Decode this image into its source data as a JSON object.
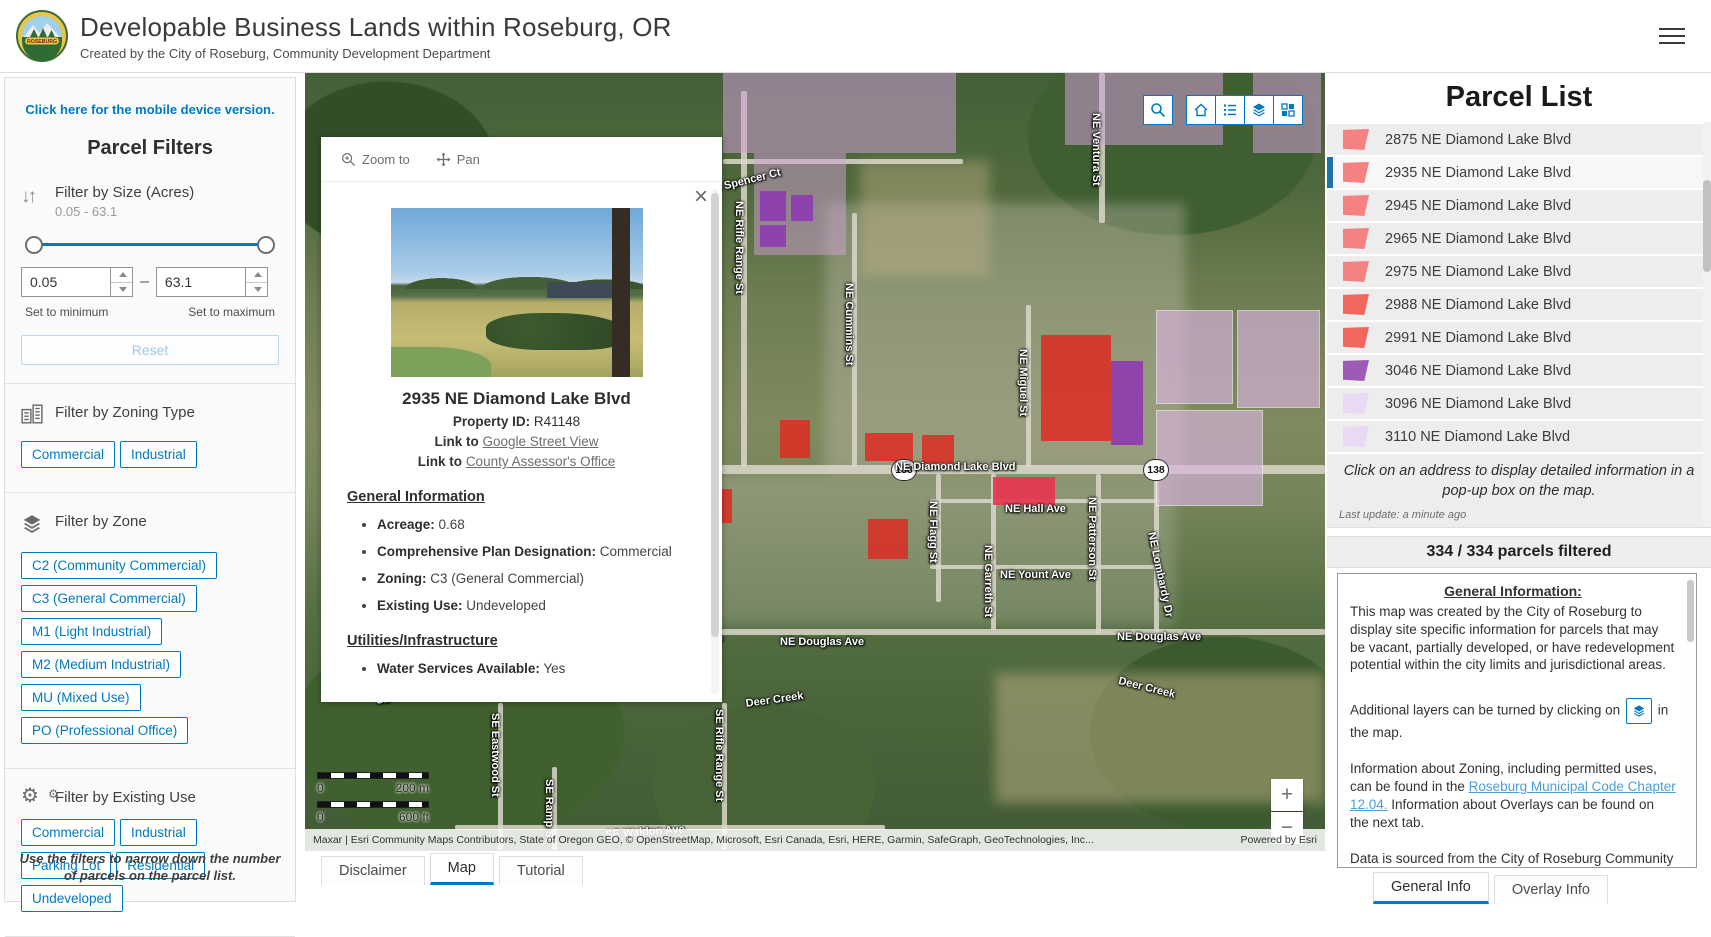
{
  "header": {
    "title": "Developable Business Lands within Roseburg, OR",
    "subtitle": "Created by the City of Roseburg, Community Development Department",
    "logo_text": "ROSEBURG"
  },
  "filters": {
    "mobile_link": "Click here for the mobile device version.",
    "title": "Parcel Filters",
    "size": {
      "label": "Filter by Size (Acres)",
      "range_text": "0.05 - 63.1",
      "min_value": "0.05",
      "max_value": "63.1",
      "separator": "–",
      "min_caption": "Set to minimum",
      "max_caption": "Set to maximum",
      "reset_label": "Reset"
    },
    "zoning_type": {
      "label": "Filter by Zoning Type",
      "buttons": [
        "Commercial",
        "Industrial"
      ]
    },
    "zone": {
      "label": "Filter by Zone",
      "buttons": [
        "C2 (Community Commercial)",
        "C3 (General Commercial)",
        "M1 (Light Industrial)",
        "M2 (Medium Industrial)",
        "MU (Mixed Use)",
        "PO (Professional Office)"
      ]
    },
    "existing_use": {
      "label": "Filter by Existing Use",
      "buttons": [
        "Commercial",
        "Industrial",
        "Parking Lot",
        "Residential",
        "Undeveloped"
      ]
    },
    "footer_note": "Use the filters to narrow down the number of parcels on the parcel list."
  },
  "popup": {
    "zoom_to": "Zoom to",
    "pan": "Pan",
    "title": "2935 NE Diamond Lake Blvd",
    "property_id_label": "Property ID:",
    "property_id": "R41148",
    "link_label": "Link to",
    "link1": "Google Street View",
    "link2": "County Assessor's Office",
    "section_general": "General Information",
    "general_bullets": [
      {
        "label": "Acreage:",
        "value": "0.68"
      },
      {
        "label": "Comprehensive Plan Designation:",
        "value": "Commercial"
      },
      {
        "label": "Zoning:",
        "value": "C3 (General Commercial)"
      },
      {
        "label": "Existing Use:",
        "value": "Undeveloped"
      }
    ],
    "section_utilities": "Utilities/Infrastructure",
    "utilities_bullets": [
      {
        "label": "Water Services Available:",
        "value": "Yes"
      }
    ]
  },
  "map": {
    "toolbar_icons": [
      "search",
      "home",
      "legend",
      "layers",
      "basemap"
    ],
    "zoom_in": "+",
    "zoom_out": "−",
    "scale_m_start": "0",
    "scale_m_end": "200 m",
    "scale_ft_start": "0",
    "scale_ft_end": "600 ft",
    "attribution": "Maxar | Esri Community Maps Contributors, State of Oregon GEO, © OpenStreetMap, Microsoft, Esri Canada, Esri, HERE, Garmin, SafeGraph, GeoTechnologies, Inc...",
    "powered_by": "Powered by Esri",
    "highway_shields": [
      {
        "text": "138",
        "x": 586,
        "y": 386
      },
      {
        "text": "138",
        "x": 838,
        "y": 386
      }
    ],
    "street_labels": [
      {
        "text": "NE Spencer Ct",
        "x": 400,
        "y": 112,
        "r": -14
      },
      {
        "text": "NE Rifle Range St",
        "x": 440,
        "y": 128,
        "r": 90
      },
      {
        "text": "NE Cummins St",
        "x": 550,
        "y": 210,
        "r": 90
      },
      {
        "text": "NE Ventura St",
        "x": 797,
        "y": 40,
        "r": 90
      },
      {
        "text": "NE Miguel St",
        "x": 724,
        "y": 276,
        "r": 90
      },
      {
        "text": "NE Diamond Lake Blvd",
        "x": 590,
        "y": 388,
        "r": 0
      },
      {
        "text": "NE Hall Ave",
        "x": 700,
        "y": 430,
        "r": 0
      },
      {
        "text": "NE Flagg St",
        "x": 634,
        "y": 428,
        "r": 90
      },
      {
        "text": "NE Garreth St",
        "x": 689,
        "y": 472,
        "r": 90
      },
      {
        "text": "NE Yount Ave",
        "x": 695,
        "y": 496,
        "r": 0
      },
      {
        "text": "NE Patterson St",
        "x": 793,
        "y": 424,
        "r": 90
      },
      {
        "text": "NE Lombardy Dr",
        "x": 852,
        "y": 458,
        "r": 78
      },
      {
        "text": "Ave",
        "x": 398,
        "y": 560,
        "r": 0
      },
      {
        "text": "NE Douglas Ave",
        "x": 475,
        "y": 563,
        "r": 0
      },
      {
        "text": "NE Douglas Ave",
        "x": 812,
        "y": 558,
        "r": 0
      },
      {
        "text": "Deer Creek",
        "x": 440,
        "y": 625,
        "r": -8
      },
      {
        "text": "Deer Creek",
        "x": 815,
        "y": 602,
        "r": 14
      },
      {
        "text": "SE Hillside Dr",
        "x": 70,
        "y": 622,
        "r": -10
      },
      {
        "text": "SE Eastwood St",
        "x": 196,
        "y": 640,
        "r": 90
      },
      {
        "text": "SE Ramp St",
        "x": 250,
        "y": 706,
        "r": 90
      },
      {
        "text": "SE Rifle Range St",
        "x": 420,
        "y": 636,
        "r": 90
      },
      {
        "text": "SE Waldon Ave",
        "x": 300,
        "y": 756,
        "r": -4
      }
    ],
    "roads": [
      {
        "x": 18,
        "y": 392,
        "w": 1002,
        "h": 9
      },
      {
        "x": 395,
        "y": 556,
        "w": 625,
        "h": 6
      },
      {
        "x": 150,
        "y": 752,
        "w": 430,
        "h": 5
      },
      {
        "x": 418,
        "y": 86,
        "w": 240,
        "h": 5
      },
      {
        "x": 436,
        "y": 18,
        "w": 6,
        "h": 376
      },
      {
        "x": 547,
        "y": 140,
        "w": 5,
        "h": 254
      },
      {
        "x": 794,
        "y": 0,
        "w": 6,
        "h": 150
      },
      {
        "x": 721,
        "y": 232,
        "w": 5,
        "h": 162
      },
      {
        "x": 631,
        "y": 401,
        "w": 5,
        "h": 128
      },
      {
        "x": 686,
        "y": 401,
        "w": 5,
        "h": 156
      },
      {
        "x": 791,
        "y": 401,
        "w": 5,
        "h": 160
      },
      {
        "x": 849,
        "y": 401,
        "w": 5,
        "h": 168
      },
      {
        "x": 625,
        "y": 426,
        "w": 230,
        "h": 4
      },
      {
        "x": 625,
        "y": 492,
        "w": 230,
        "h": 4
      },
      {
        "x": 193,
        "y": 630,
        "w": 5,
        "h": 147
      },
      {
        "x": 247,
        "y": 694,
        "w": 5,
        "h": 83
      },
      {
        "x": 417,
        "y": 630,
        "w": 5,
        "h": 147
      }
    ],
    "features": [
      {
        "x": 418,
        "y": 0,
        "w": 233,
        "h": 80,
        "c": "#cf9fd6",
        "o": 0.55
      },
      {
        "x": 449,
        "y": 80,
        "w": 92,
        "h": 102,
        "c": "#cf9fd6",
        "o": 0.5
      },
      {
        "x": 760,
        "y": 0,
        "w": 158,
        "h": 72,
        "c": "#cf9fd6",
        "o": 0.55
      },
      {
        "x": 948,
        "y": 0,
        "w": 68,
        "h": 80,
        "c": "#cf9fd6",
        "o": 0.55
      },
      {
        "x": 851,
        "y": 237,
        "w": 77,
        "h": 94,
        "c": "#d9b3e0",
        "o": 0.65,
        "b": 1
      },
      {
        "x": 932,
        "y": 237,
        "w": 83,
        "h": 98,
        "c": "#d9b3e0",
        "o": 0.65,
        "b": 1
      },
      {
        "x": 851,
        "y": 337,
        "w": 107,
        "h": 96,
        "c": "#d9b3e0",
        "o": 0.65,
        "b": 1
      },
      {
        "x": 455,
        "y": 118,
        "w": 26,
        "h": 30,
        "c": "#8d3bb0",
        "o": 0.9
      },
      {
        "x": 486,
        "y": 122,
        "w": 22,
        "h": 26,
        "c": "#8d3bb0",
        "o": 0.9
      },
      {
        "x": 455,
        "y": 152,
        "w": 26,
        "h": 22,
        "c": "#8d3bb0",
        "o": 0.9
      },
      {
        "x": 806,
        "y": 288,
        "w": 32,
        "h": 84,
        "c": "#8d3bb0",
        "o": 0.9
      },
      {
        "x": 736,
        "y": 262,
        "w": 70,
        "h": 106,
        "c": "#dd2b21",
        "o": 0.85
      },
      {
        "x": 475,
        "y": 347,
        "w": 30,
        "h": 38,
        "c": "#dd2b21",
        "o": 0.85
      },
      {
        "x": 560,
        "y": 360,
        "w": 48,
        "h": 28,
        "c": "#dd2b21",
        "o": 0.85
      },
      {
        "x": 617,
        "y": 362,
        "w": 32,
        "h": 28,
        "c": "#dd2b21",
        "o": 0.85
      },
      {
        "x": 688,
        "y": 404,
        "w": 62,
        "h": 28,
        "c": "#e8334f",
        "o": 0.9
      },
      {
        "x": 405,
        "y": 416,
        "w": 22,
        "h": 34,
        "c": "#dd2b21",
        "o": 0.85
      },
      {
        "x": 563,
        "y": 446,
        "w": 40,
        "h": 40,
        "c": "#dd2b21",
        "o": 0.85
      }
    ]
  },
  "map_tabs": [
    {
      "label": "Disclaimer",
      "active": false
    },
    {
      "label": "Map",
      "active": true
    },
    {
      "label": "Tutorial",
      "active": false
    }
  ],
  "parcel_list": {
    "title": "Parcel List",
    "items": [
      {
        "address": "2875 NE Diamond Lake Blvd",
        "color": "#f58181",
        "selected": false
      },
      {
        "address": "2935 NE Diamond Lake Blvd",
        "color": "#f58181",
        "selected": true
      },
      {
        "address": "2945 NE Diamond Lake Blvd",
        "color": "#f58181",
        "selected": false
      },
      {
        "address": "2965 NE Diamond Lake Blvd",
        "color": "#f58181",
        "selected": false
      },
      {
        "address": "2975 NE Diamond Lake Blvd",
        "color": "#f58181",
        "selected": false
      },
      {
        "address": "2988 NE Diamond Lake Blvd",
        "color": "#f2665e",
        "selected": false
      },
      {
        "address": "2991 NE Diamond Lake Blvd",
        "color": "#f2665e",
        "selected": false
      },
      {
        "address": "3046 NE Diamond Lake Blvd",
        "color": "#9d5bb5",
        "selected": false
      },
      {
        "address": "3096 NE Diamond Lake Blvd",
        "color": "#e9d9f4",
        "selected": false
      },
      {
        "address": "3110 NE Diamond Lake Blvd",
        "color": "#e9d9f4",
        "selected": false
      }
    ],
    "note": "Click on  an address to display detailed information in a pop-up box on the map.",
    "last_update": "Last update: a minute ago",
    "filter_count": "334 / 334 parcels filtered"
  },
  "info_panel": {
    "heading": "General Information:",
    "p1": "This map was created by the City of Roseburg to display site specific information for parcels that may be vacant, partially developed, or have redevelopment potential within the city limits and jurisdictional areas.",
    "p2_before": "Additional layers can be turned by clicking on",
    "p2_after": " in the map.",
    "p3_before": "Information about Zoning, including permitted uses, can be found in the ",
    "p3_link": "Roseburg Municipal Code Chapter 12.04.",
    "p3_after": " Information about Overlays can be found on the next tab.",
    "p4": "Data is sourced from the City of Roseburg Community Development Department, Public Works Department, Douglas County Assessor's Office, Oregon"
  },
  "info_tabs": [
    {
      "label": "General Info",
      "active": true
    },
    {
      "label": "Overlay Info",
      "active": false
    }
  ],
  "colors": {
    "accent": "#0079c1",
    "selected_bar": "#1d72ae",
    "parcel_red": "#dd2b21",
    "parcel_purple": "#8d3bb0",
    "overlay_pink": "#cf9fd6"
  }
}
